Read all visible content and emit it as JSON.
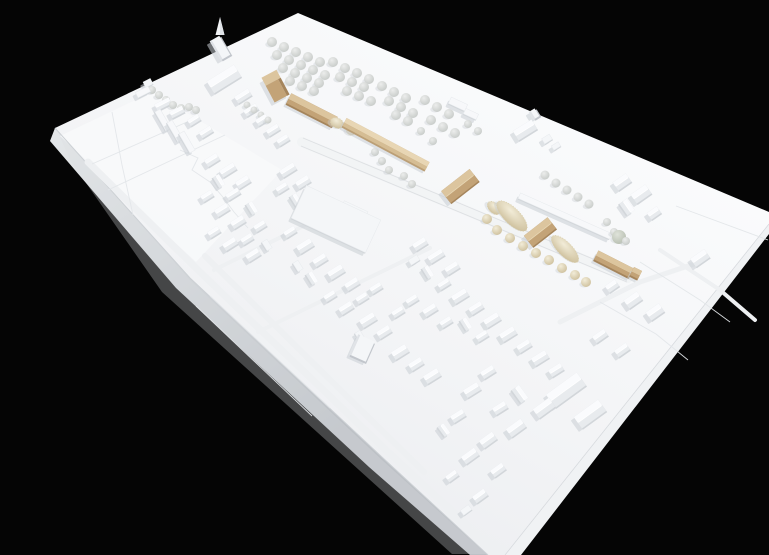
{
  "scene": {
    "subject": "photograph of a white architectural urban massing model with wooden proposal buildings, model trees and terrain, on black background",
    "background": "#050505"
  },
  "palette": {
    "background": "#050505",
    "board_hi": "#fbfcfd",
    "board_mid": "#f3f4f6",
    "board_lo": "#eaecef",
    "side_light": "#e4e7e9",
    "side_dark": "#bdc1c6",
    "side_se": "#f0f2f4",
    "shadow": "#c9cdd3",
    "roof_bright": "#fafbfd",
    "roof_mid": "#e8ebee",
    "wall": "#d2d6da",
    "wall_dark": "#c2c6cc",
    "flat_top": "#f4f6f8",
    "slab_top": "#f7f8fa",
    "road": "#eef0f2",
    "rail_band": "#f2f4f5",
    "line": "#d8dbdf",
    "crease": "#e3e6e9",
    "edge_line": "#cdd1d5",
    "ridge": "#ffffff",
    "tan_top": "#dcc59e",
    "tan_mid": "#c3a377",
    "tan_dark": "#a5855c",
    "tan_ridge": "#e8d8b6",
    "tanlight_top": "#e8d6b4",
    "tanlight_mid": "#d5bd94",
    "tanlight_dark": "#bb9f76",
    "tree_gray_in": "#ecedec",
    "tree_gray_out": "#c6cac7",
    "tree_beige_in": "#f2ecd8",
    "tree_beige_out": "#cdbf9b",
    "tree_green_in": "#dfe3da",
    "tree_green_out": "#b7beb0",
    "hedge_stroke": "#d8cdaa"
  },
  "board": {
    "surface": [
      [
        55,
        128
      ],
      [
        298,
        13
      ],
      [
        769,
        212
      ],
      [
        769,
        224
      ],
      [
        505,
        555
      ],
      [
        488,
        555
      ],
      [
        383,
        458
      ],
      [
        190,
        278
      ]
    ],
    "side_sw": [
      [
        55,
        128
      ],
      [
        190,
        278
      ],
      [
        383,
        458
      ],
      [
        488,
        555
      ],
      [
        470,
        555
      ],
      [
        369,
        467
      ],
      [
        176,
        288
      ],
      [
        50,
        141
      ]
    ],
    "side_se": [
      [
        769,
        224
      ],
      [
        505,
        555
      ],
      [
        521,
        555
      ],
      [
        769,
        234
      ]
    ],
    "inner_shade": [
      [
        58,
        132
      ],
      [
        190,
        280
      ],
      [
        382,
        460
      ],
      [
        486,
        554
      ],
      [
        452,
        554
      ],
      [
        162,
        292
      ],
      [
        70,
        160
      ]
    ],
    "field": [
      [
        60,
        136
      ],
      [
        152,
        92
      ],
      [
        282,
        170
      ],
      [
        196,
        262
      ]
    ]
  },
  "roads": [
    {
      "pts": [
        [
          88,
          162
        ],
        [
          200,
          272
        ],
        [
          388,
          452
        ],
        [
          468,
          526
        ]
      ],
      "w": 7
    },
    {
      "pts": [
        [
          205,
          256
        ],
        [
          310,
          360
        ],
        [
          424,
          472
        ]
      ],
      "w": 6
    },
    {
      "pts": [
        [
          214,
          270
        ],
        [
          332,
          212
        ]
      ],
      "w": 4
    },
    {
      "pts": [
        [
          258,
          332
        ],
        [
          430,
          248
        ]
      ],
      "w": 4
    },
    {
      "pts": [
        [
          560,
          322
        ],
        [
          640,
          282
        ],
        [
          700,
          262
        ]
      ],
      "w": 5
    },
    {
      "pts": [
        [
          660,
          250
        ],
        [
          720,
          290
        ],
        [
          755,
          320
        ]
      ],
      "w": 4
    }
  ],
  "rail": {
    "band": [
      [
        302,
        142
      ],
      [
        628,
        278
      ]
    ],
    "w": 10,
    "lines": [
      [
        [
          303,
          138
        ],
        [
          629,
          274
        ]
      ],
      [
        [
          301,
          146
        ],
        [
          627,
          282
        ]
      ]
    ]
  },
  "creases": [
    [
      [
        92,
        164
      ],
      [
        196,
        118
      ]
    ],
    [
      [
        108,
        190
      ],
      [
        225,
        135
      ]
    ],
    [
      [
        112,
        112
      ],
      [
        122,
        165
      ],
      [
        133,
        215
      ]
    ],
    [
      [
        676,
        206
      ],
      [
        768,
        240
      ]
    ],
    [
      [
        640,
        262
      ],
      [
        700,
        300
      ],
      [
        730,
        322
      ]
    ],
    [
      [
        600,
        302
      ],
      [
        656,
        334
      ],
      [
        688,
        360
      ]
    ],
    [
      [
        180,
        150
      ],
      [
        198,
        158
      ],
      [
        192,
        170
      ],
      [
        210,
        182
      ],
      [
        222,
        196
      ],
      [
        234,
        212
      ],
      [
        248,
        228
      ]
    ],
    [
      [
        312,
        206
      ],
      [
        362,
        230
      ]
    ],
    [
      [
        320,
        198
      ],
      [
        370,
        221
      ]
    ],
    [
      [
        210,
        296
      ],
      [
        330,
        408
      ]
    ],
    [
      [
        196,
        306
      ],
      [
        312,
        416
      ]
    ]
  ],
  "white_buildings": [
    [
      148,
      83,
      8,
      6,
      -27,
      "f"
    ],
    [
      143,
      92,
      14,
      6,
      -27,
      "s"
    ],
    [
      163,
      104,
      16,
      7,
      -27,
      "g"
    ],
    [
      177,
      112,
      14,
      7,
      -27,
      "g"
    ],
    [
      163,
      120,
      22,
      6,
      60,
      "s"
    ],
    [
      175,
      131,
      22,
      6,
      60,
      "s"
    ],
    [
      187,
      142,
      22,
      6,
      60,
      "s"
    ],
    [
      194,
      120,
      12,
      7,
      -32,
      "g"
    ],
    [
      206,
      132,
      13,
      7,
      -32,
      "g"
    ],
    [
      224,
      79,
      32,
      14,
      -32,
      "g"
    ],
    [
      220,
      48,
      11,
      22,
      -30,
      "t"
    ],
    [
      243,
      96,
      16,
      8,
      -32,
      "g"
    ],
    [
      251,
      110,
      14,
      7,
      -32,
      "g"
    ],
    [
      262,
      120,
      12,
      7,
      -32,
      "g"
    ],
    [
      273,
      130,
      13,
      7,
      -32,
      "g"
    ],
    [
      283,
      140,
      12,
      7,
      -32,
      "g"
    ],
    [
      458,
      104,
      18,
      7,
      25,
      "s"
    ],
    [
      471,
      114,
      14,
      6,
      25,
      "s"
    ],
    [
      525,
      130,
      22,
      11,
      -32,
      "g"
    ],
    [
      534,
      114,
      7,
      9,
      -32,
      "t"
    ],
    [
      547,
      139,
      9,
      6,
      -32,
      "f"
    ],
    [
      556,
      146,
      8,
      5,
      -32,
      "f"
    ],
    [
      622,
      182,
      16,
      10,
      -35,
      "g"
    ],
    [
      641,
      194,
      18,
      11,
      -35,
      "g"
    ],
    [
      627,
      207,
      14,
      9,
      55,
      "g"
    ],
    [
      654,
      213,
      12,
      8,
      -35,
      "g"
    ],
    [
      212,
      160,
      14,
      8,
      -32,
      "g"
    ],
    [
      228,
      170,
      16,
      8,
      -32,
      "g"
    ],
    [
      243,
      182,
      14,
      8,
      -32,
      "g"
    ],
    [
      219,
      181,
      12,
      7,
      58,
      "g"
    ],
    [
      207,
      196,
      12,
      7,
      -32,
      "g"
    ],
    [
      233,
      194,
      14,
      7,
      -32,
      "g"
    ],
    [
      222,
      210,
      14,
      8,
      -32,
      "g"
    ],
    [
      252,
      208,
      12,
      7,
      58,
      "g"
    ],
    [
      238,
      222,
      14,
      8,
      -32,
      "g"
    ],
    [
      214,
      232,
      12,
      7,
      -32,
      "g"
    ],
    [
      260,
      226,
      12,
      7,
      -32,
      "g"
    ],
    [
      230,
      244,
      14,
      8,
      -32,
      "g"
    ],
    [
      247,
      239,
      12,
      7,
      -32,
      "g"
    ],
    [
      253,
      255,
      14,
      8,
      -32,
      "g"
    ],
    [
      267,
      245,
      10,
      6,
      58,
      "f"
    ],
    [
      288,
      170,
      16,
      8,
      -32,
      "g"
    ],
    [
      303,
      182,
      14,
      8,
      -32,
      "g"
    ],
    [
      282,
      188,
      12,
      7,
      -32,
      "g"
    ],
    [
      296,
      200,
      12,
      7,
      58,
      "g"
    ],
    [
      336,
      219,
      82,
      36,
      25,
      "F"
    ],
    [
      353,
      213,
      26,
      15,
      25,
      "f"
    ],
    [
      565,
      216,
      100,
      6,
      24,
      "s"
    ],
    [
      305,
      246,
      16,
      9,
      -32,
      "g"
    ],
    [
      290,
      232,
      12,
      7,
      -32,
      "g"
    ],
    [
      320,
      260,
      14,
      8,
      -32,
      "g"
    ],
    [
      336,
      272,
      16,
      9,
      -32,
      "g"
    ],
    [
      352,
      284,
      14,
      8,
      -32,
      "g"
    ],
    [
      312,
      278,
      12,
      7,
      58,
      "g"
    ],
    [
      298,
      266,
      10,
      6,
      58,
      "f"
    ],
    [
      330,
      296,
      12,
      7,
      -32,
      "g"
    ],
    [
      346,
      308,
      14,
      8,
      -32,
      "g"
    ],
    [
      362,
      298,
      12,
      7,
      -32,
      "g"
    ],
    [
      376,
      288,
      12,
      7,
      -32,
      "g"
    ],
    [
      368,
      320,
      16,
      9,
      -32,
      "g"
    ],
    [
      384,
      332,
      14,
      8,
      -32,
      "g"
    ],
    [
      360,
      336,
      10,
      6,
      58,
      "f"
    ],
    [
      398,
      312,
      12,
      7,
      -32,
      "g"
    ],
    [
      412,
      300,
      12,
      7,
      -32,
      "g"
    ],
    [
      420,
      244,
      14,
      8,
      -32,
      "g"
    ],
    [
      436,
      256,
      16,
      8,
      -32,
      "g"
    ],
    [
      452,
      268,
      14,
      8,
      -32,
      "g"
    ],
    [
      428,
      272,
      12,
      7,
      58,
      "g"
    ],
    [
      444,
      284,
      12,
      7,
      -32,
      "g"
    ],
    [
      414,
      260,
      10,
      6,
      -32,
      "f"
    ],
    [
      460,
      296,
      16,
      9,
      -32,
      "g"
    ],
    [
      476,
      308,
      14,
      8,
      -32,
      "g"
    ],
    [
      492,
      320,
      16,
      9,
      -32,
      "g"
    ],
    [
      466,
      324,
      12,
      7,
      58,
      "g"
    ],
    [
      482,
      336,
      12,
      7,
      -32,
      "g"
    ],
    [
      430,
      310,
      14,
      8,
      -32,
      "g"
    ],
    [
      446,
      322,
      12,
      7,
      -32,
      "g"
    ],
    [
      362,
      348,
      18,
      22,
      24,
      "t"
    ],
    [
      400,
      352,
      16,
      9,
      -32,
      "g"
    ],
    [
      416,
      364,
      14,
      8,
      -32,
      "g"
    ],
    [
      432,
      376,
      16,
      9,
      -32,
      "g"
    ],
    [
      508,
      334,
      16,
      9,
      -32,
      "g"
    ],
    [
      524,
      346,
      14,
      8,
      -32,
      "g"
    ],
    [
      540,
      358,
      16,
      9,
      -32,
      "g"
    ],
    [
      556,
      370,
      14,
      8,
      -32,
      "g"
    ],
    [
      566,
      390,
      38,
      16,
      -36,
      "g"
    ],
    [
      590,
      414,
      30,
      14,
      -36,
      "g"
    ],
    [
      544,
      408,
      20,
      11,
      -36,
      "g"
    ],
    [
      520,
      394,
      16,
      9,
      54,
      "g"
    ],
    [
      488,
      372,
      14,
      8,
      -32,
      "g"
    ],
    [
      472,
      390,
      16,
      9,
      -32,
      "g"
    ],
    [
      500,
      408,
      14,
      8,
      -32,
      "g"
    ],
    [
      516,
      428,
      18,
      10,
      -36,
      "g"
    ],
    [
      488,
      440,
      16,
      9,
      -36,
      "g"
    ],
    [
      458,
      416,
      14,
      8,
      -32,
      "g"
    ],
    [
      444,
      430,
      12,
      7,
      54,
      "g"
    ],
    [
      470,
      456,
      16,
      9,
      -36,
      "g"
    ],
    [
      498,
      470,
      14,
      8,
      -36,
      "g"
    ],
    [
      452,
      476,
      12,
      7,
      -36,
      "g"
    ],
    [
      480,
      496,
      14,
      8,
      -36,
      "g"
    ],
    [
      466,
      510,
      10,
      6,
      -36,
      "f"
    ],
    [
      700,
      258,
      17,
      10,
      -35,
      "g"
    ],
    [
      633,
      300,
      16,
      10,
      -35,
      "g"
    ],
    [
      655,
      312,
      16,
      10,
      -35,
      "g"
    ],
    [
      612,
      286,
      12,
      8,
      -35,
      "g"
    ],
    [
      600,
      336,
      14,
      8,
      -35,
      "g"
    ],
    [
      622,
      350,
      14,
      8,
      -35,
      "g"
    ]
  ],
  "tan_buildings": [
    [
      276,
      87,
      17,
      26,
      -28,
      "tower"
    ],
    [
      312,
      110,
      52,
      11,
      27,
      "bar"
    ],
    [
      386,
      144,
      94,
      9,
      28,
      "barlight"
    ],
    [
      460,
      186,
      36,
      15,
      -38,
      "gable"
    ],
    [
      540,
      232,
      30,
      14,
      -38,
      "gable"
    ],
    [
      614,
      264,
      40,
      10,
      27,
      "bar"
    ],
    [
      636,
      273,
      9,
      9,
      27,
      "cube"
    ]
  ],
  "spires": [
    [
      220,
      30,
      -30
    ]
  ],
  "hedges": [
    [
      337,
      123,
      7,
      5,
      27
    ],
    [
      351,
      131,
      5,
      4,
      27
    ],
    [
      512,
      216,
      20,
      8,
      45
    ],
    [
      565,
      249,
      18,
      7,
      45
    ],
    [
      494,
      208,
      8,
      5,
      45
    ]
  ],
  "trees": {
    "gray": [
      [
        152,
        90,
        4
      ],
      [
        159,
        95,
        4
      ],
      [
        166,
        100,
        4
      ],
      [
        173,
        105,
        4
      ],
      [
        181,
        108,
        4
      ],
      [
        189,
        107,
        4
      ],
      [
        196,
        110,
        4
      ],
      [
        247,
        105,
        3.5
      ],
      [
        254,
        110,
        3.5
      ],
      [
        261,
        115,
        3.5
      ],
      [
        268,
        120,
        3.5
      ],
      [
        272,
        42,
        5
      ],
      [
        284,
        47,
        5
      ],
      [
        296,
        52,
        5
      ],
      [
        308,
        57,
        5
      ],
      [
        320,
        62,
        5
      ],
      [
        277,
        55,
        5
      ],
      [
        289,
        60,
        5
      ],
      [
        301,
        65,
        5
      ],
      [
        313,
        70,
        5
      ],
      [
        325,
        75,
        5
      ],
      [
        283,
        68,
        5
      ],
      [
        295,
        73,
        5
      ],
      [
        307,
        78,
        5
      ],
      [
        319,
        83,
        5
      ],
      [
        290,
        81,
        5
      ],
      [
        302,
        86,
        5
      ],
      [
        314,
        91,
        5
      ],
      [
        333,
        62,
        5
      ],
      [
        345,
        68,
        5
      ],
      [
        357,
        73,
        5
      ],
      [
        369,
        79,
        5
      ],
      [
        340,
        77,
        5
      ],
      [
        352,
        82,
        5
      ],
      [
        364,
        87,
        5
      ],
      [
        347,
        91,
        5
      ],
      [
        359,
        96,
        5
      ],
      [
        371,
        101,
        5
      ],
      [
        382,
        86,
        5
      ],
      [
        394,
        92,
        5
      ],
      [
        406,
        98,
        5
      ],
      [
        389,
        101,
        5
      ],
      [
        401,
        107,
        5
      ],
      [
        413,
        113,
        5
      ],
      [
        396,
        115,
        5
      ],
      [
        408,
        121,
        5
      ],
      [
        425,
        100,
        5
      ],
      [
        437,
        107,
        5
      ],
      [
        449,
        114,
        5
      ],
      [
        431,
        120,
        5
      ],
      [
        443,
        127,
        5
      ],
      [
        455,
        133,
        5
      ],
      [
        421,
        131,
        4
      ],
      [
        433,
        141,
        4
      ],
      [
        468,
        124,
        4
      ],
      [
        478,
        131,
        4
      ],
      [
        375,
        152,
        4
      ],
      [
        382,
        161,
        4
      ],
      [
        389,
        170,
        4
      ],
      [
        404,
        176,
        4
      ],
      [
        412,
        184,
        4
      ],
      [
        545,
        175,
        4.5
      ],
      [
        556,
        183,
        4.5
      ],
      [
        567,
        190,
        4.5
      ],
      [
        578,
        197,
        4.5
      ],
      [
        589,
        204,
        4.5
      ],
      [
        607,
        222,
        4
      ],
      [
        614,
        232,
        4
      ],
      [
        626,
        241,
        4
      ]
    ],
    "beige": [
      [
        497,
        230,
        5
      ],
      [
        510,
        238,
        5
      ],
      [
        523,
        246,
        5
      ],
      [
        536,
        253,
        5
      ],
      [
        549,
        260,
        5
      ],
      [
        562,
        268,
        5
      ],
      [
        575,
        275,
        5
      ],
      [
        586,
        282,
        5
      ],
      [
        487,
        219,
        5
      ]
    ],
    "green": [
      [
        619,
        237,
        7
      ]
    ]
  }
}
